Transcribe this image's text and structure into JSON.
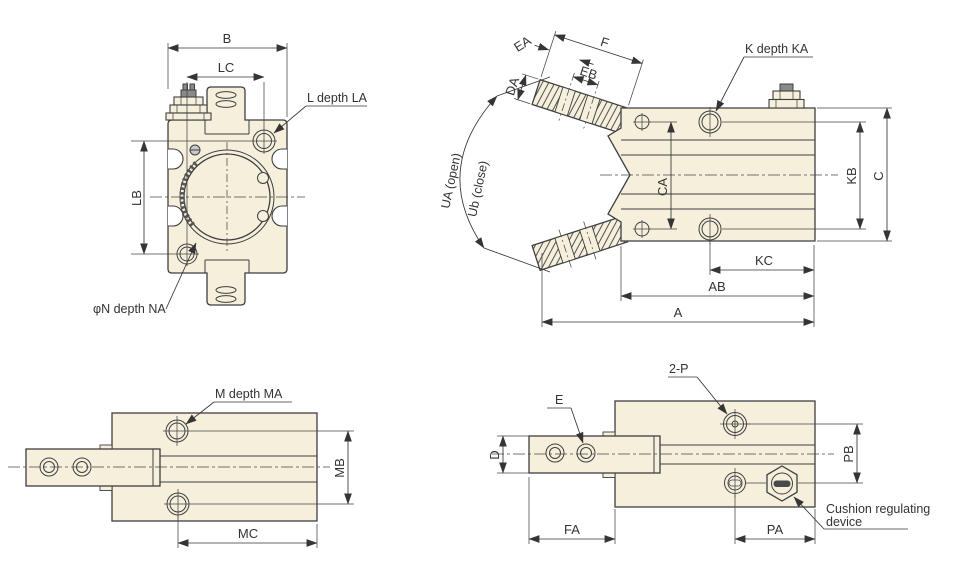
{
  "drawing_type": "technical-dimension-drawing",
  "component": "pneumatic-gripper-cylinder",
  "colors": {
    "body_fill": "#f5efdc",
    "outline": "#3f3f3f",
    "dim_line": "#353535",
    "text": "#333333",
    "background": "#ffffff"
  },
  "views": {
    "front": {
      "dim_b": "B",
      "dim_lc": "LC",
      "dim_lb": "LB",
      "callout_l": "L depth LA",
      "callout_n": "φN depth NA"
    },
    "side": {
      "dim_ea": "EA",
      "dim_f": "F",
      "dim_eb": "EB",
      "dim_da": "DA",
      "callout_k": "K depth KA",
      "angle_open": "UA (open)",
      "angle_close": "Ub (close)",
      "dim_ca": "CA",
      "dim_kb": "KB",
      "dim_c": "C",
      "dim_kc": "KC",
      "dim_ab": "AB",
      "dim_a": "A"
    },
    "bottom": {
      "callout_m": "M depth MA",
      "dim_mb": "MB",
      "dim_mc": "MC"
    },
    "side_section": {
      "callout_e": "E",
      "callout_p": "2-P",
      "dim_d": "D",
      "dim_pb": "PB",
      "dim_fa": "FA",
      "dim_pa": "PA",
      "cushion_line1": "Cushion regulating",
      "cushion_line2": "device"
    }
  }
}
